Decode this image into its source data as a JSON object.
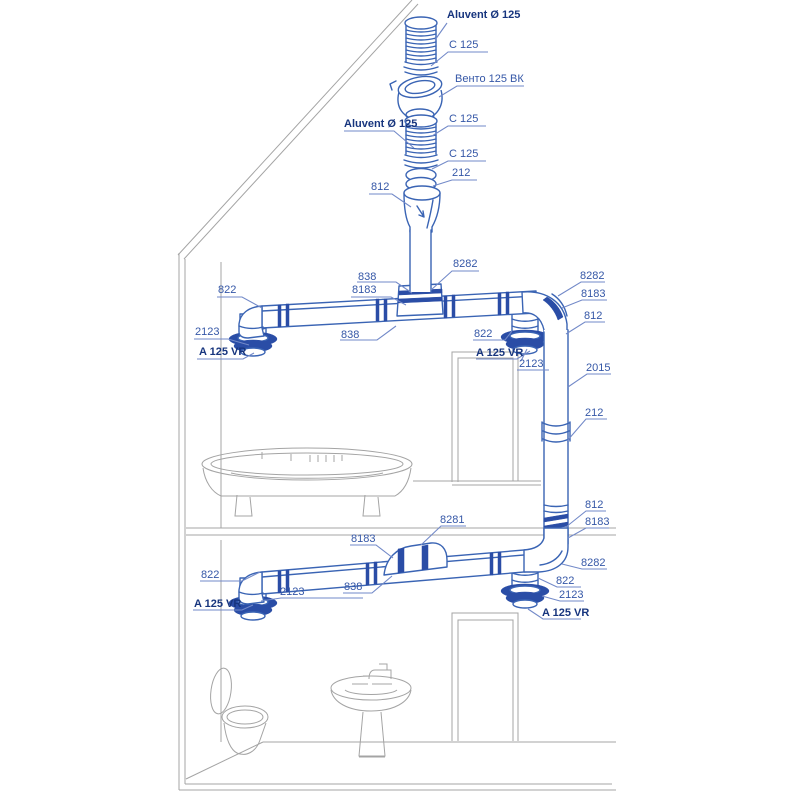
{
  "colors": {
    "background": "#ffffff",
    "duct_outline": "#3a64b4",
    "duct_dark_band": "#2a4da6",
    "leader_line": "#7289c8",
    "label_text": "#3557a7",
    "label_text_bold": "#17357e",
    "house_outline": "#a4a4a4"
  },
  "callouts": [
    {
      "text": "Aluvent Ø 125",
      "bold": true
    },
    {
      "text": "C 125",
      "bold": false
    },
    {
      "text": "Венто 125 ВК",
      "bold": false
    },
    {
      "text": "Aluvent Ø 125",
      "bold": true
    },
    {
      "text": "C 125",
      "bold": false
    },
    {
      "text": "C 125",
      "bold": false
    },
    {
      "text": "212",
      "bold": false
    },
    {
      "text": "812",
      "bold": false
    },
    {
      "text": "822",
      "bold": false
    },
    {
      "text": "2123",
      "bold": false
    },
    {
      "text": "A 125 VR",
      "bold": true
    },
    {
      "text": "838",
      "bold": false
    },
    {
      "text": "8183",
      "bold": false
    },
    {
      "text": "8282",
      "bold": false
    },
    {
      "text": "838",
      "bold": false
    },
    {
      "text": "822",
      "bold": false
    },
    {
      "text": "A 125 VR",
      "bold": true
    },
    {
      "text": "2123",
      "bold": false
    },
    {
      "text": "8282",
      "bold": false
    },
    {
      "text": "8183",
      "bold": false
    },
    {
      "text": "812",
      "bold": false
    },
    {
      "text": "2015",
      "bold": false
    },
    {
      "text": "212",
      "bold": false
    },
    {
      "text": "812",
      "bold": false
    },
    {
      "text": "8183",
      "bold": false
    },
    {
      "text": "8282",
      "bold": false
    },
    {
      "text": "8281",
      "bold": false
    },
    {
      "text": "8183",
      "bold": false
    },
    {
      "text": "838",
      "bold": false
    },
    {
      "text": "822",
      "bold": false
    },
    {
      "text": "2123",
      "bold": false
    },
    {
      "text": "A 125 VR",
      "bold": true
    },
    {
      "text": "822",
      "bold": false
    },
    {
      "text": "2123",
      "bold": false
    },
    {
      "text": "A 125 VR",
      "bold": true
    }
  ]
}
